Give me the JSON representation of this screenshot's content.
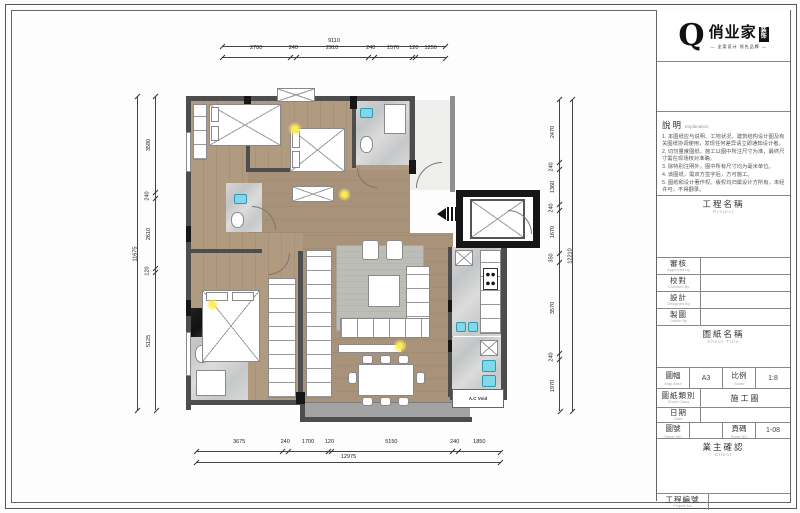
{
  "logo": {
    "q": "Q",
    "brand": "俏业家",
    "suffix": "装饰",
    "tagline": "— 全案设计 领先品牌 —"
  },
  "title_block": {
    "explanation": {
      "label": "說明",
      "sublabel": "Explanation",
      "notes": [
        "1. 本图纸应与说明、工地状况、建筑结构设计图及有关图纸协调使用，发现任何差异请立即通知设计者。",
        "2. 切勿量度图纸，施工以图中所注尺寸为准，最终尺寸需在现场核对准确。",
        "3. 除特别注明外，图中所有尺寸均为毫米单位。",
        "4. 该图纸，需双方签字后，方可施工。",
        "5. 图纸和设计著作权、版权均归属设计方所有，未经许可，不得翻录。"
      ]
    },
    "project": {
      "label": "工程名稱",
      "sublabel": "Project"
    },
    "fields": [
      {
        "label": "審核",
        "sublabel": "Approved By",
        "value": ""
      },
      {
        "label": "校對",
        "sublabel": "Checked By",
        "value": ""
      },
      {
        "label": "設計",
        "sublabel": "Designed By",
        "value": ""
      },
      {
        "label": "製圖",
        "sublabel": "Drawn By",
        "value": ""
      }
    ],
    "sheet_title": {
      "label": "圖紙名稱",
      "sublabel": "Sheet Title"
    },
    "map_area": {
      "label": "圖幅",
      "sublabel": "Map Area",
      "value": "A3"
    },
    "scale": {
      "label": "比例",
      "sublabel": "Scale",
      "value": "1:8"
    },
    "sheet_class": {
      "label": "圖紙類別",
      "sublabel": "Sheet Class",
      "value": "施工圖"
    },
    "date": {
      "label": "日期",
      "sublabel": "Date",
      "value": ""
    },
    "sheet_no": {
      "label": "圖號",
      "sublabel": "Sheet NO",
      "value": ""
    },
    "page_no": {
      "label": "頁碼",
      "sublabel": "Page NO",
      "value": "1-08"
    },
    "client": {
      "label": "業主確認",
      "sublabel": "Client"
    },
    "project_no": {
      "label": "工程編號",
      "sublabel": "Project No",
      "value": ""
    }
  },
  "plan": {
    "ac_void_label": "A.C Void"
  },
  "dimensions": {
    "top": {
      "overall": "9110",
      "segments": [
        "2780",
        "240",
        "2910",
        "240",
        "1570",
        "120",
        "1250"
      ]
    },
    "bottom": {
      "overall": "12975",
      "segments": [
        "3675",
        "240",
        "1700",
        "120",
        "5150",
        "240",
        "1850"
      ]
    },
    "left": {
      "overall": "11675",
      "segments": [
        "3580",
        "240",
        "2610",
        "120",
        "5125"
      ]
    },
    "right": {
      "overall": "12210",
      "segments": [
        "2470",
        "240",
        "1360",
        "240",
        "1670",
        "350",
        "3570",
        "240",
        "1970"
      ]
    }
  },
  "colors": {
    "wood": "#b19b80",
    "wall": "#4d4d4d",
    "marble": "#cfd1d2",
    "accent_blue": "#7fd9ea",
    "accent_yellow": "#ffec55",
    "line": "#444444"
  }
}
